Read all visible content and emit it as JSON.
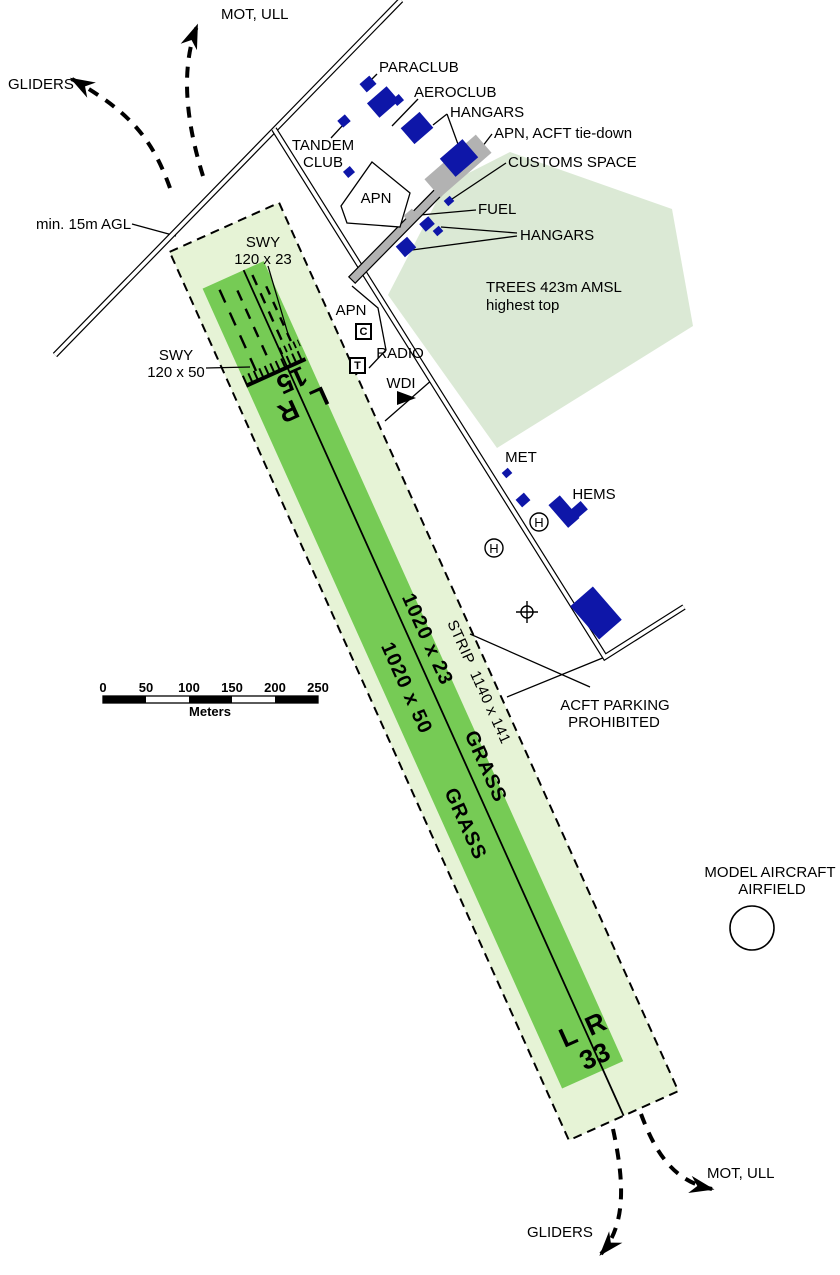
{
  "colors": {
    "runway_green": "#76cb55",
    "strip_green": "#e6f3d6",
    "trees_green": "#dbe9d5",
    "building_blue": "#0e16a8",
    "apron_gray": "#b2b2b2",
    "line_black": "#000000"
  },
  "routes": {
    "gliders_top": "GLIDERS",
    "mot_top": "MOT, ULL",
    "mot_bottom": "MOT, ULL",
    "gliders_bottom": "GLIDERS"
  },
  "labels": {
    "min_agl": "min. 15m AGL",
    "swy_ne_1": "SWY",
    "swy_ne_2": "120 x 23",
    "swy_sw_1": "SWY",
    "swy_sw_2": "120 x 50",
    "tandem_1": "TANDEM",
    "tandem_2": "CLUB",
    "paraclub": "PARACLUB",
    "aeroclub": "AEROCLUB",
    "hangars_top": "HANGARS",
    "apn_tiedown": "APN, ACFT tie-down",
    "customs": "CUSTOMS SPACE",
    "fuel": "FUEL",
    "hangars_lower": "HANGARS",
    "apn_north": "APN",
    "apn_mid": "APN",
    "radio": "RADIO",
    "wdi": "WDI",
    "trees_1": "TREES 423m AMSL",
    "trees_2": "highest top",
    "met": "MET",
    "hems": "HEMS",
    "helipad": "H",
    "acft_1": "ACFT PARKING",
    "acft_2": "PROHIBITED",
    "model_1": "MODEL AIRCRAFT",
    "model_2": "AIRFIELD",
    "symbol_c": "C",
    "symbol_t": "T"
  },
  "runway": {
    "strip_dim": "STRIP  1140 x 141",
    "rwy_ne_dim": "1020 x 23",
    "rwy_ne_surface": "GRASS",
    "rwy_sw_dim": "1020 x 50",
    "rwy_sw_surface": "GRASS",
    "thr_north_num": "15",
    "thr_north_l": "L",
    "thr_north_r": "R",
    "thr_south_num": "33",
    "thr_south_l": "L",
    "thr_south_r": "R"
  },
  "scale_bar": {
    "ticks": [
      "0",
      "50",
      "100",
      "150",
      "200",
      "250"
    ],
    "unit": "Meters"
  }
}
